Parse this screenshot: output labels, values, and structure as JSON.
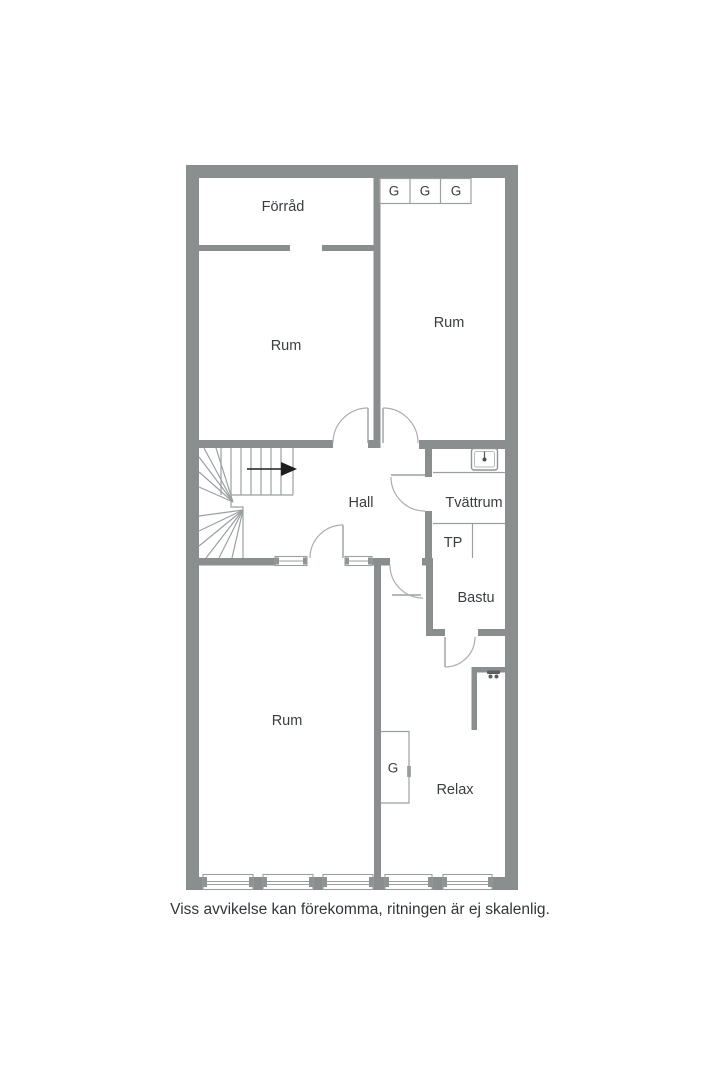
{
  "floorplan": {
    "rooms": {
      "forrad": "Förråd",
      "rum_top_left": "Rum",
      "rum_top_right": "Rum",
      "hall": "Hall",
      "tvattrum": "Tvättrum",
      "tp": "TP",
      "bastu": "Bastu",
      "rum_bottom": "Rum",
      "relax": "Relax"
    },
    "closets": {
      "g1": "G",
      "g2": "G",
      "g3": "G",
      "g_relax": "G"
    },
    "fixtures": {
      "sink": "sink-icon",
      "shower_mixer": "shower-mixer-icon",
      "stairs": "winder-staircase",
      "stair_direction": "right"
    }
  },
  "caption": "Viss avvikelse kan förekomma, ritningen är ej skalenlig.",
  "colors": {
    "wall": "#8a8e8f",
    "line": "#9aa0a2",
    "door": "#abaeb0",
    "text": "#3a3e41",
    "arrow": "#1e1e1e",
    "background": "#ffffff"
  }
}
